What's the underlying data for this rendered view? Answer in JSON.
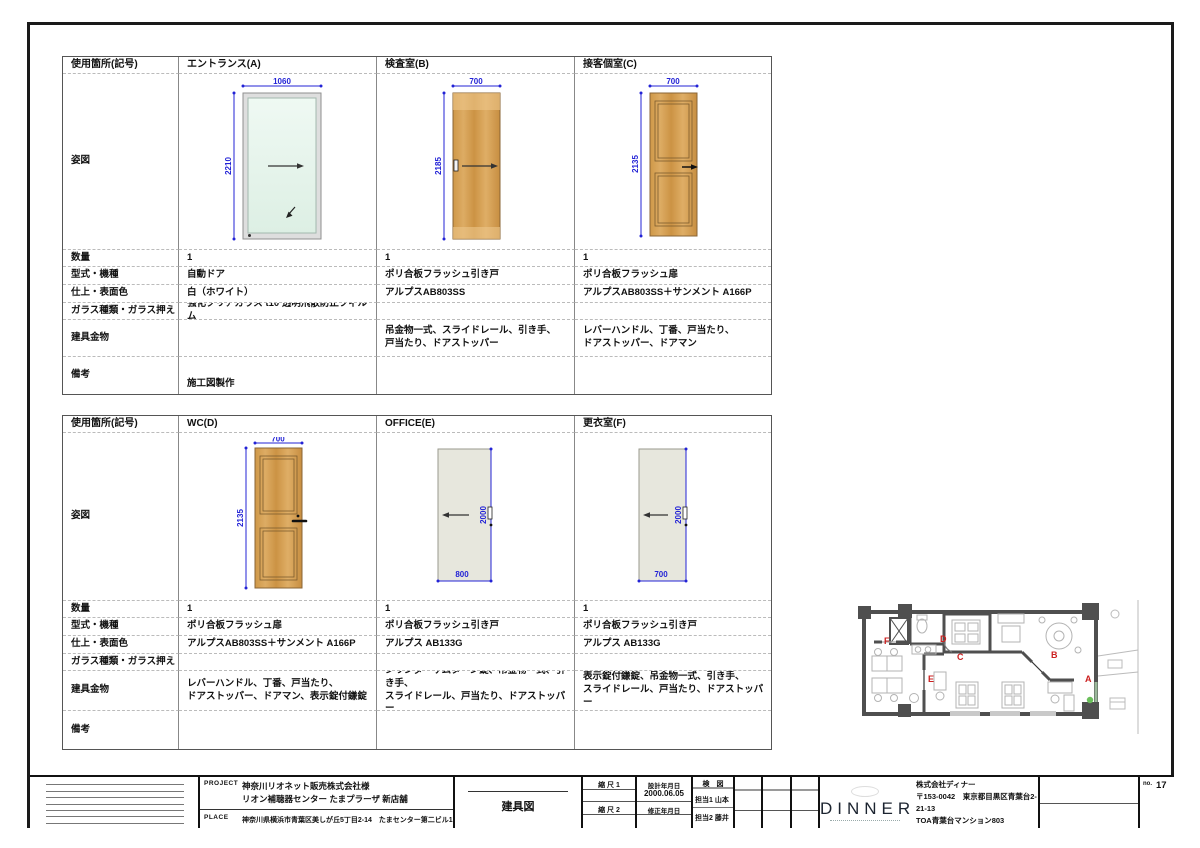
{
  "row_labels": {
    "location": "使用箇所(記号)",
    "elevation": "姿図",
    "qty": "数量",
    "type": "型式・機種",
    "finish": "仕上・表面色",
    "glass": "ガラス種類・ガラス押え",
    "hardware": "建具金物",
    "remarks": "備考"
  },
  "tables": [
    {
      "columns": [
        {
          "name": "エントランス(A)",
          "dim_w": "1060",
          "dim_h": "2210",
          "qty": "1",
          "type": "自動ドア",
          "finish": "白（ホワイト）",
          "glass": "強化クリアガラス t10 透明飛散防止フィルム",
          "hardware1": "",
          "hardware2": "",
          "remarks": "施工図製作"
        },
        {
          "name": "検査室(B)",
          "dim_w": "700",
          "dim_h": "2185",
          "qty": "1",
          "type": "ポリ合板フラッシュ引き戸",
          "finish": "アルプスAB803SS",
          "glass": "",
          "hardware1": "吊金物一式、スライドレール、引き手、",
          "hardware2": "戸当たり、ドアストッパー",
          "remarks": ""
        },
        {
          "name": "接客個室(C)",
          "dim_w": "700",
          "dim_h": "2135",
          "qty": "1",
          "type": "ポリ合板フラッシュ扉",
          "finish": "アルプスAB803SS＋サンメント A166P",
          "glass": "",
          "hardware1": "レバーハンドル、丁番、戸当たり、",
          "hardware2": "ドアストッパー、ドアマン",
          "remarks": ""
        }
      ]
    },
    {
      "columns": [
        {
          "name": "WC(D)",
          "dim_w": "700",
          "dim_h": "2135",
          "qty": "1",
          "type": "ポリ合板フラッシュ扉",
          "finish": "アルプスAB803SS＋サンメント A166P",
          "glass": "",
          "hardware1": "レバーハンドル、丁番、戸当たり、",
          "hardware2": "ドアストッパー、ドアマン、表示錠付鎌錠",
          "remarks": ""
        },
        {
          "name": "OFFICE(E)",
          "dim_w": "800",
          "dim_h": "2000",
          "qty": "1",
          "type": "ポリ合板フラッシュ引き戸",
          "finish": "アルプス AB133G",
          "glass": "",
          "hardware1": "シリンダーサムターン錠、吊金物一式、引き手、",
          "hardware2": "スライドレール、戸当たり、ドアストッパー",
          "remarks": ""
        },
        {
          "name": "更衣室(F)",
          "dim_w": "700",
          "dim_h": "2000",
          "qty": "1",
          "type": "ポリ合板フラッシュ引き戸",
          "finish": "アルプス AB133G",
          "glass": "",
          "hardware1": "表示錠付鎌錠、吊金物一式、引き手、",
          "hardware2": "スライドレール、戸当たり、ドアストッパー",
          "remarks": ""
        }
      ]
    }
  ],
  "title_block": {
    "project_label": "PROJECT",
    "place_label": "PLACE",
    "project_line1": "神奈川リオネット販売株式会社様",
    "project_line2": "リオン補聴器センター たまプラーザ 新店舗",
    "place": "神奈川県横浜市青葉区美しが丘5丁目2-14　たまセンター第二ビル1階",
    "drawing_title": "建具図",
    "scale1_label": "縮 尺 1",
    "scale2_label": "縮 尺 2",
    "design_date_label": "設計年月日",
    "design_date": "2000.06.05",
    "revise_date_label": "修正年月日",
    "check_label": "検　図",
    "staff1": "担当1 山本",
    "staff2": "担当2 藤井",
    "company_logo": "DINNER",
    "company_name": "株式会社ディナー",
    "company_addr1": "〒153-0042　東京都目黒区青葉台2-21-13",
    "company_addr2": "TOA青葉台マンション803",
    "no_label": "no.",
    "page_no": "17"
  },
  "plan": {
    "labels": [
      "A",
      "B",
      "C",
      "D",
      "E",
      "F"
    ],
    "label_color": "#cc2020"
  },
  "colors": {
    "dimension_blue": "#2323d6",
    "wood": "#d3a055",
    "glass_green": "#e9f6ef",
    "gray_door": "#e7e7dd",
    "wall_gray": "#4f4f4f",
    "marker_green": "#6abf5a"
  }
}
